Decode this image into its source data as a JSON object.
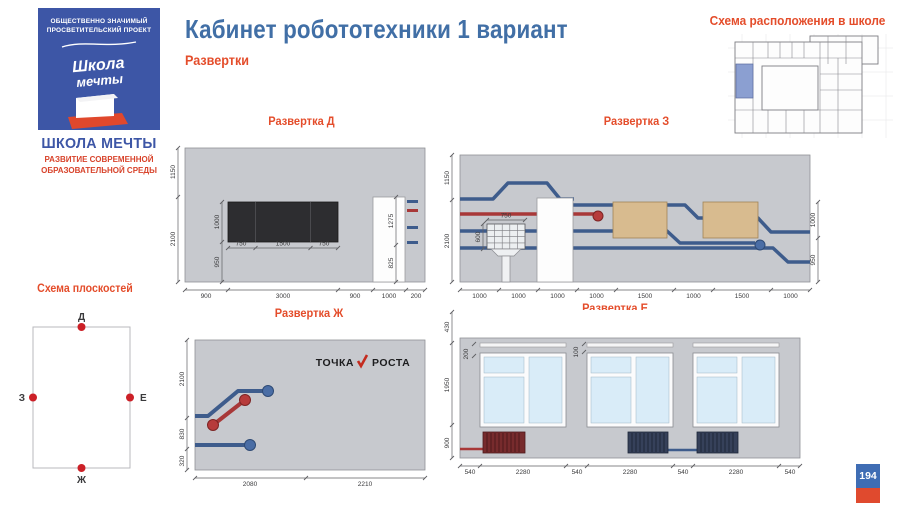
{
  "header": {
    "title": "Кабинет робототехники 1 вариант",
    "subtitle": "Развертки"
  },
  "logo": {
    "project_line1": "ОБЩЕСТВЕННО ЗНАЧИМЫЙ",
    "project_line2": "ПРОСВЕТИТЕЛЬСКИЙ ПРОЕКТ",
    "script_line1": "Школа",
    "script_line2": "мечты",
    "name": "ШКОЛА МЕЧТЫ",
    "tagline1": "РАЗВИТИЕ СОВРЕМЕННОЙ",
    "tagline2": "ОБРАЗОВАТЕЛЬНОЙ СРЕДЫ"
  },
  "location_map": {
    "title": "Схема расположения в школе"
  },
  "plane_schema": {
    "title": "Схема плоскостей",
    "top": "Д",
    "right": "Е",
    "bottom": "Ж",
    "left": "З"
  },
  "elev_d": {
    "title": "Развертка Д",
    "left_dims": [
      "1150",
      "2100"
    ],
    "inner_v_dims": [
      "1000",
      "950"
    ],
    "inner_h_dims": [
      "750",
      "1500",
      "750"
    ],
    "door_dims": [
      "1275",
      "825"
    ],
    "bottom_dims": [
      "900",
      "3000",
      "900",
      "1000",
      "200"
    ]
  },
  "elev_z": {
    "title": "Развертка З",
    "left_dims": [
      "1150",
      "2100"
    ],
    "right_dims": [
      "1000",
      "950"
    ],
    "board_w": "750",
    "board_h": "600",
    "bottom_dims": [
      "1000",
      "1000",
      "1000",
      "1000",
      "1500",
      "1000",
      "1500",
      "1000"
    ]
  },
  "elev_zh": {
    "title": "Развертка Ж",
    "logo_left": "ТОЧКА",
    "logo_right": "РОСТА",
    "left_dims": [
      "2100",
      "830",
      "320"
    ],
    "bottom_dims": [
      "2080",
      "2210"
    ]
  },
  "elev_e": {
    "title": "Развертка Е",
    "left_dims": [
      "430",
      "1950",
      "900"
    ],
    "inner_dims": [
      "200",
      "100"
    ],
    "bottom_dims": [
      "540",
      "2280",
      "540",
      "2280",
      "540",
      "2280",
      "540"
    ]
  },
  "page_number": "194",
  "colors": {
    "accent_blue": "#416fa6",
    "accent_red": "#e44d2b",
    "logo_blue": "#3d56a6",
    "wall_gray": "#c7c9ce",
    "pipe_blue": "#3e5c8c",
    "pipe_red": "#a83838",
    "board_black": "#2d2d30",
    "board_tan": "#d8bb8f",
    "glass_blue": "#d9ecf8",
    "radiator_red": "#772b2d",
    "radiator_navy": "#36415a",
    "highlight_room": "#8b9fd1"
  }
}
